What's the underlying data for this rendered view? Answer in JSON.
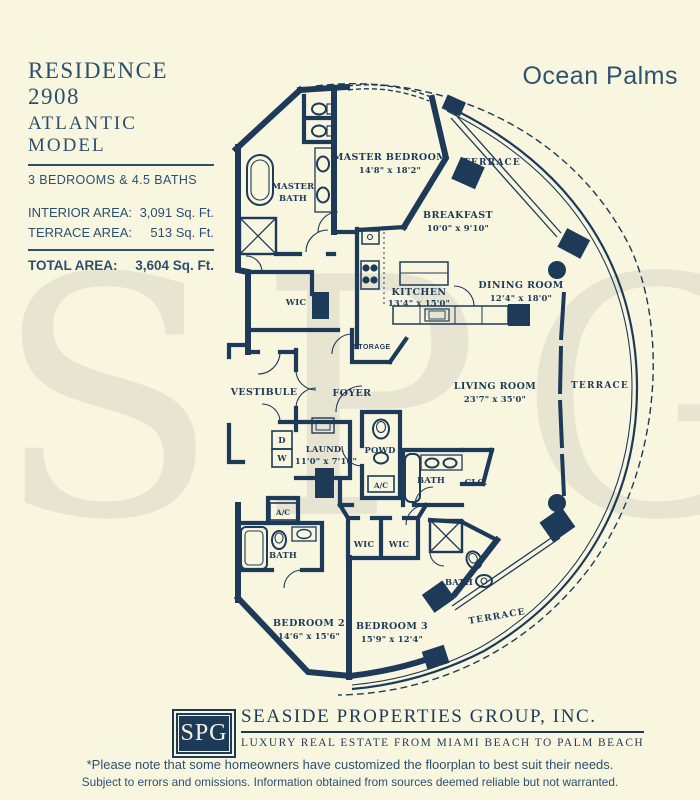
{
  "colors": {
    "background": "#f9f6e0",
    "ink": "#1d3a59",
    "header_text": "#2b506f",
    "watermark": "#e7e4d2",
    "logo_bg": "#1d3a59",
    "logo_text": "#f6f3e4"
  },
  "watermark": {
    "text": "SPG"
  },
  "header": {
    "title_line1": "RESIDENCE 2908",
    "title_line2": "ATLANTIC MODEL",
    "subtitle": "3 BEDROOMS & 4.5 BATHS",
    "area_rows": [
      {
        "label": "INTERIOR AREA:",
        "value": "3,091 Sq. Ft."
      },
      {
        "label": "TERRACE AREA:",
        "value": "513 Sq. Ft."
      }
    ],
    "total_label": "TOTAL AREA:",
    "total_value": "3,604 Sq. Ft.",
    "building_name": "Ocean Palms"
  },
  "floorplan": {
    "rooms": {
      "master_bath": {
        "line1": "MASTER",
        "line2": "BATH"
      },
      "master_bedroom": {
        "name": "MASTER BEDROOM",
        "dims": "14'8\" x 18'2\""
      },
      "terrace_top": {
        "name": "TERRACE"
      },
      "breakfast": {
        "name": "BREAKFAST",
        "dims": "10'0\" x 9'10\""
      },
      "dining_room": {
        "name": "DINING ROOM",
        "dims": "12'4\" x 18'0\""
      },
      "kitchen": {
        "name": "KITCHEN",
        "dims": "13'4\" x 15'0\""
      },
      "wic_master": {
        "name": "WIC"
      },
      "storage": {
        "name": "STORAGE"
      },
      "vestibule": {
        "name": "VESTIBULE"
      },
      "foyer": {
        "name": "FOYER"
      },
      "living_room": {
        "name": "LIVING ROOM",
        "dims": "23'7\" x 35'0\""
      },
      "terrace_right": {
        "name": "TERRACE"
      },
      "laundry": {
        "name": "LAUND.",
        "dims": "11'0\" x 7'10\""
      },
      "powder": {
        "name": "POWD"
      },
      "ac_hall": {
        "name": "A/C"
      },
      "bath_3": {
        "name": "BATH"
      },
      "closet": {
        "name": "CLO."
      },
      "ac_2": {
        "name": "A/C"
      },
      "bath_2": {
        "name": "BATH"
      },
      "wic_bed2": {
        "name": "WIC"
      },
      "wic_bed3": {
        "name": "WIC"
      },
      "bedroom_2": {
        "name": "BEDROOM 2",
        "dims": "14'6\" x 15'6\""
      },
      "bedroom_3": {
        "name": "BEDROOM 3",
        "dims": "15'9\" x 12'4\""
      },
      "bath_4": {
        "name": "BATH"
      },
      "terrace_bottom": {
        "name": "TERRACE"
      },
      "dryer": {
        "name": "D"
      },
      "washer": {
        "name": "W"
      }
    }
  },
  "footer": {
    "logo_text": "SPG",
    "company_name": "SEASIDE PROPERTIES GROUP, INC.",
    "tagline": "LUXURY REAL ESTATE FROM MIAMI BEACH TO PALM BEACH"
  },
  "disclaimer": {
    "line1": "*Please note that some homeowners have customized the floorplan to best suit their needs.",
    "line2": "Subject to errors and omissions. Information obtained from sources deemed reliable but not warranted."
  }
}
